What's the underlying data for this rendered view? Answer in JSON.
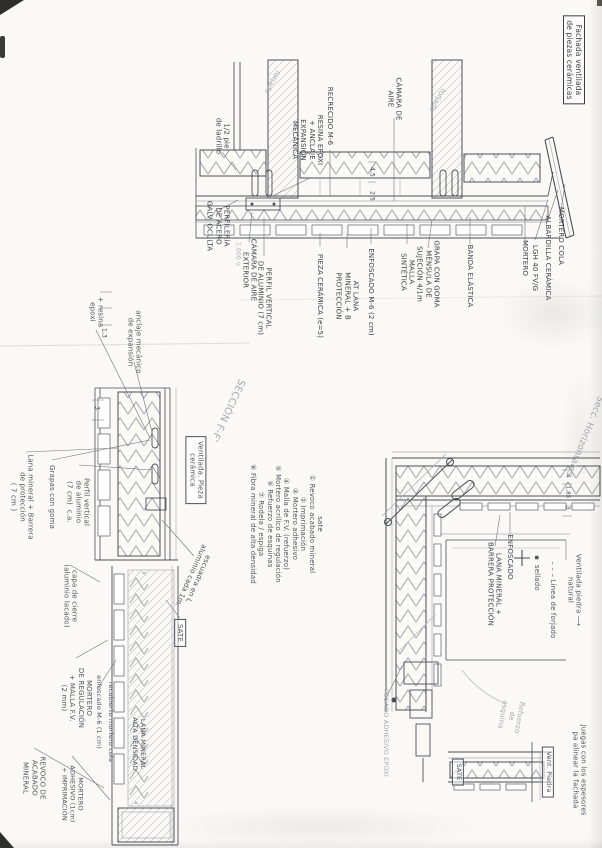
{
  "title_box": {
    "text": "Fachada ventilada\nde piezas cerámicas"
  },
  "colors": {
    "ink": "#3a3f47",
    "pen": "#4e545d",
    "pencil": "#a6aaaf",
    "line": "#4a4f57",
    "lightline": "#a9adb3"
  },
  "sate_list": {
    "title": "sate",
    "items": [
      "Revoco acabado mineral",
      "Imprimación",
      "Mortero adhesivo",
      "Malla de F.V. (refuerzo)",
      "Mortero acrílico de regulación",
      "Refuerzo de esquinas",
      "Rodela / espiga",
      "Fibra mineral de alta densidad"
    ],
    "x": 286,
    "y": 524,
    "s": 7,
    "c": "pen"
  },
  "labels": [
    {
      "t": "1/2 pie\nde ladrillo",
      "x": 222,
      "y": 136
    },
    {
      "t": "forjado",
      "x": 272,
      "y": 82,
      "r": 118,
      "c": "pencil"
    },
    {
      "t": "forjado",
      "x": 437,
      "y": 100,
      "r": 118,
      "c": "pencil"
    },
    {
      "t": "RESINA EPOXI\n+ ANCLAJE\nEXPANSIÓN\nMECÁNICA",
      "x": 307,
      "y": 140
    },
    {
      "t": "RECRECIDO M-6",
      "x": 330,
      "y": 116
    },
    {
      "t": "CÁMARA DE\nAIRE",
      "x": 394,
      "y": 99
    },
    {
      "t": "PERFILERÍA\nDE ACERO\nGALV. OCULTA",
      "x": 218,
      "y": 226
    },
    {
      "t": "1.000 u",
      "x": 238,
      "y": 254,
      "c": "pencil",
      "s": 6
    },
    {
      "t": "CÁMARA DE AIRE\nEXTERIOR",
      "x": 249,
      "y": 270
    },
    {
      "t": "PERFIL VERTICAL\nDE ALUMINIO (7 cm)",
      "x": 264,
      "y": 298
    },
    {
      "t": "PIEZA CERÁMICA (e=5)",
      "x": 320,
      "y": 296
    },
    {
      "t": "AT LANA\nMINERAL + B\nPROTECCIÓN",
      "x": 347,
      "y": 296
    },
    {
      "t": "ENFOSCADO M-6 (2 cm)",
      "x": 371,
      "y": 292
    },
    {
      "t": "MALLA\nSINTÉTICA",
      "x": 407,
      "y": 272
    },
    {
      "t": "GRAPA CON GOMA\nMÉNSULA DE\nSUJECIÓN 4/1m",
      "x": 428,
      "y": 274
    },
    {
      "t": "BANDA ELÁSTICA",
      "x": 470,
      "y": 276
    },
    {
      "t": "MORTERO",
      "x": 525,
      "y": 258
    },
    {
      "t": "LGH 40 FV/G",
      "x": 535,
      "y": 268
    },
    {
      "t": "ALBARDILLA CERÁMICA",
      "x": 548,
      "y": 258
    },
    {
      "t": "MORTERO COLA",
      "x": 561,
      "y": 236
    },
    {
      "t": "4,5",
      "x": 372,
      "y": 172,
      "s": 6
    },
    {
      "t": "2,5",
      "x": 372,
      "y": 196,
      "s": 6
    },
    {
      "t": "+ resina\nepoxi",
      "x": 96,
      "y": 312,
      "c": "pen"
    },
    {
      "t": "anclaje mecánico\nde expansión",
      "x": 134,
      "y": 342,
      "c": "pen"
    },
    {
      "t": "1,3",
      "x": 104,
      "y": 333,
      "s": 6
    },
    {
      "t": "3",
      "x": 97,
      "y": 408,
      "s": 6
    },
    {
      "t": "SECCIÓN F-F'",
      "x": 227,
      "y": 410,
      "r": 115,
      "c": "pencil",
      "s": 10
    },
    {
      "t": "Ventilada. Pieza\ncerámica",
      "x": 196,
      "y": 470,
      "b": 1,
      "c": "pen"
    },
    {
      "t": "escuadra en L\naluminio cada 1m.",
      "x": 194,
      "y": 577,
      "r": 114,
      "c": "pen"
    },
    {
      "t": "SATE",
      "x": 180,
      "y": 633,
      "b": 1,
      "c": "pen"
    },
    {
      "t": "Lana mineral + Barrera\nde protección\n( 7 cm )",
      "x": 22,
      "y": 497,
      "c": "pen"
    },
    {
      "t": "Grapas con goma",
      "x": 52,
      "y": 497,
      "c": "pen"
    },
    {
      "t": "Perfil vertical\nde aluminio\n(7 cm)  c.a.",
      "x": 78,
      "y": 502,
      "c": "pen"
    },
    {
      "t": "capa de cierre\n(aluminio lacado)",
      "x": 70,
      "y": 596,
      "c": "pen"
    },
    {
      "t": "enfoscado M-6 (1 cm)",
      "x": 98,
      "y": 712,
      "c": "pen",
      "s": 6.5
    },
    {
      "t": "recubierto mortero cola",
      "x": 110,
      "y": 722,
      "c": "pen",
      "s": 6.5
    },
    {
      "t": "LANA MINERAL\nALTA DENSIDAD",
      "x": 138,
      "y": 744,
      "c": "pen",
      "s": 6.5
    },
    {
      "t": "MORTERO\nDE REGULACIÓN\n+ MALLA F.V.\n(2 mm)",
      "x": 76,
      "y": 698,
      "c": "pen"
    },
    {
      "t": "REVOCO DE\nACABADO\nMINERAL",
      "x": 34,
      "y": 778,
      "c": "pen"
    },
    {
      "t": "MORTERO\nADHESIVO (1cm)\n+ IMPRIMACIÓN",
      "x": 72,
      "y": 794,
      "c": "pen",
      "s": 6.5
    },
    {
      "t": "Secc. Horizontales",
      "x": 584,
      "y": 436,
      "r": 112,
      "c": "pencil",
      "s": 9
    },
    {
      "t": "ENFOSCADO",
      "x": 510,
      "y": 557
    },
    {
      "t": "LANA MINERAL +\nBARRERA PROTECCIÓN",
      "x": 494,
      "y": 584
    },
    {
      "t": "▪  sellado",
      "x": 537,
      "y": 573,
      "c": "pen"
    },
    {
      "t": "– – – Línea de forjado",
      "x": 553,
      "y": 600,
      "c": "pen"
    },
    {
      "t": "Ventilada piedra ⟶\nnatural",
      "x": 574,
      "y": 590,
      "c": "pen"
    },
    {
      "t": "4",
      "x": 567,
      "y": 476,
      "s": 5.5
    },
    {
      "t": "1,85",
      "x": 567,
      "y": 492,
      "s": 5.5
    },
    {
      "t": "3",
      "x": 567,
      "y": 508,
      "s": 5.5
    },
    {
      "t": "PEGADO ADHESIVO EPOXI",
      "x": 385,
      "y": 733,
      "c": "pencil",
      "s": 6.5
    },
    {
      "t": "Refuerzo\nde\nesquina",
      "x": 511,
      "y": 716,
      "r": 100,
      "c": "pencil"
    },
    {
      "t": "SATE",
      "x": 458,
      "y": 772,
      "b": 1,
      "c": "pen",
      "s": 6.5
    },
    {
      "t": "Vent. Piedra",
      "x": 548,
      "y": 772,
      "b": 1,
      "c": "pen",
      "s": 6.5
    },
    {
      "t": "Juegas con los espesores\npa alinear la fachada",
      "x": 579,
      "y": 770,
      "c": "pen"
    }
  ]
}
